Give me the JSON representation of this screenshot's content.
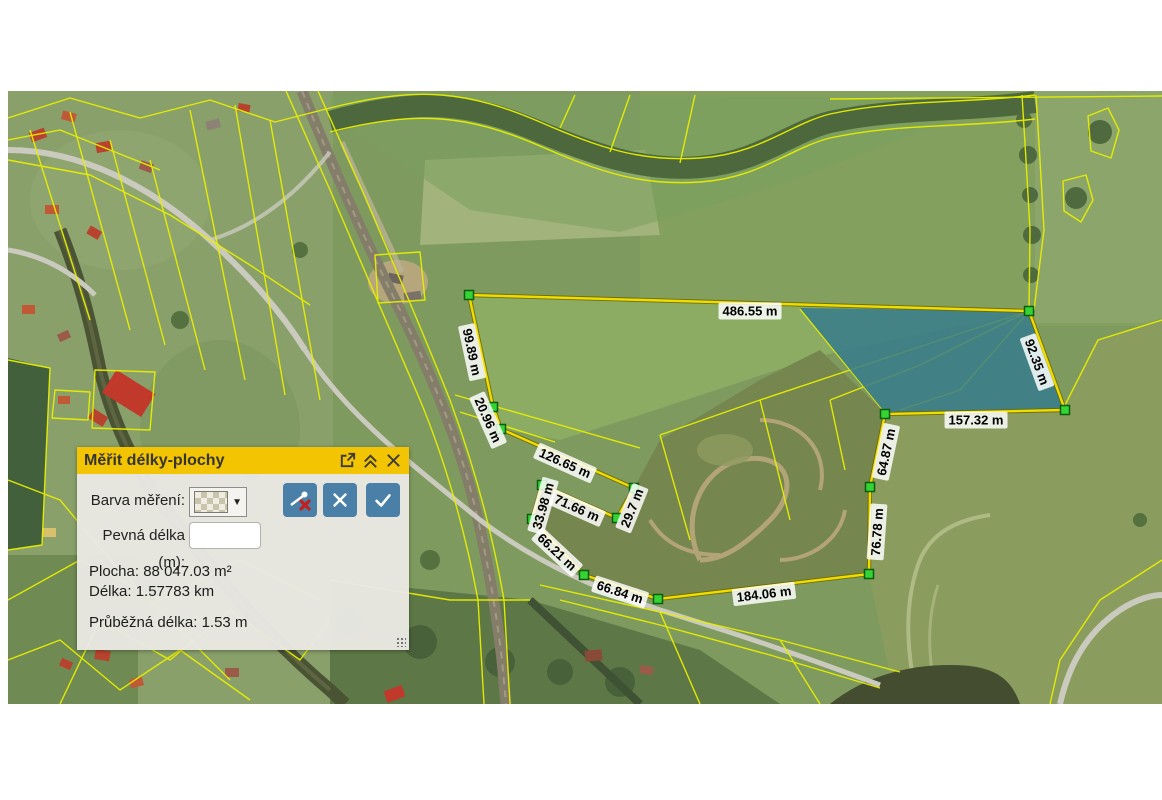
{
  "panel": {
    "title": "Měřit délky-plochy",
    "icons": {
      "popout": "open-in-new-window",
      "collapse": "double-chevron-up",
      "close": "x"
    },
    "color_row": {
      "label": "Barva měření:",
      "selected_swatch": "transparent-checker",
      "dropdown_arrow": "▼"
    },
    "fixed_length": {
      "label": "Pevná délka (m):",
      "value": ""
    },
    "stats": {
      "area_label": "Plocha:",
      "area_value": "88 047.03 m²",
      "length_label": "Délka:",
      "length_value": "1.57783 km",
      "running_label": "Průběžná délka:",
      "running_value": "1.53 m"
    },
    "colors": {
      "titlebar": "#f2c402",
      "body": "#e9e8e3",
      "button_blue": "#4a80a8",
      "button_red_x": "#c2201a"
    }
  },
  "map": {
    "measurements": [
      "486.55 m",
      "99.89 m",
      "20.96 m",
      "126.65 m",
      "71.66 m",
      "33.98 m",
      "29.7 m",
      "66.21 m",
      "66.84 m",
      "184.06 m",
      "76.78 m",
      "64.87 m",
      "157.32 m",
      "92.35 m"
    ],
    "colors": {
      "measure_line": "#f0dd00",
      "vertex_marker": "#35d435",
      "cadastral_line": "#e8ef00",
      "highlighted_parcel": "#337a8c"
    }
  }
}
